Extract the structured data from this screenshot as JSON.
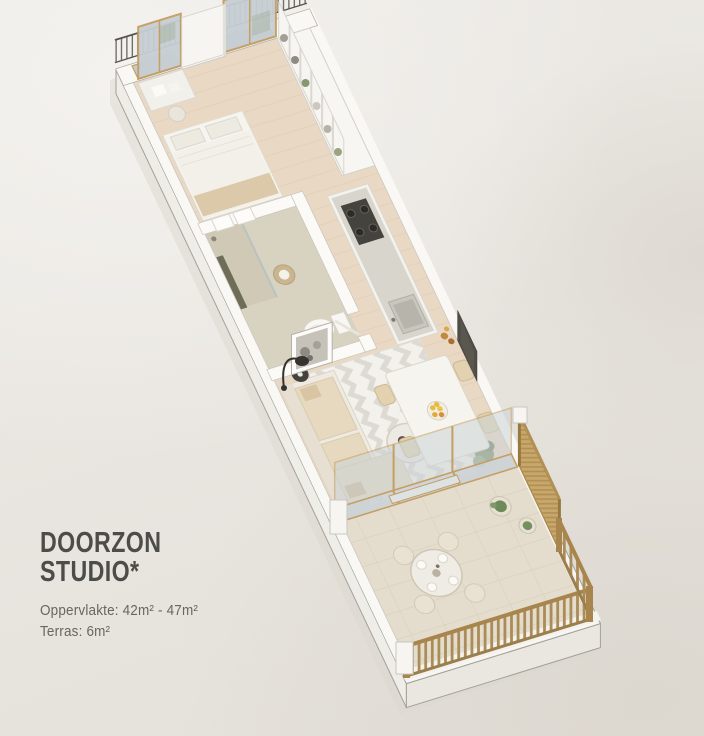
{
  "page": {
    "background": "#e8e5e0"
  },
  "title": {
    "line1": "DOORZON",
    "line2": "STUDIO*"
  },
  "details": {
    "area": "Oppervlakte: 42m² - 47m²",
    "terrace": "Terras: 6m²"
  },
  "floorplan": {
    "view": "axonometric 3D studio floor plan, long axis running top-left to bottom-right",
    "rooms": [
      "bedroom",
      "bathroom",
      "kitchen",
      "living-dining",
      "terrace"
    ],
    "features": [
      "french-balcony-railing",
      "floor-to-ceiling-windows",
      "bed",
      "desk",
      "shower",
      "toilet",
      "towel-rack",
      "built-in-shelving",
      "kitchen-counter-with-cooktop-and-sink",
      "sofa",
      "chevron-rug",
      "coffee-table",
      "arc-floor-lamp",
      "framed-artwork",
      "wall-tv",
      "dining-table-with-fruit-bowl",
      "four-chairs",
      "potted-plants",
      "sliding-glass-doors",
      "terrace-round-table",
      "wooden-slat-railing",
      "woven-privacy-screen"
    ],
    "colors": {
      "paper": "#e8e5e0",
      "slab": "#f7f6f2",
      "wood_floor": "#e9d8c4",
      "terrace_floor": "#e4ddcd",
      "glass": "#c7cfd4",
      "window_frame": "#c49e63",
      "metal_railing": "#57544d",
      "terrace_wood": "#ab8c58",
      "woven_screen": "#c8a76a",
      "plant": "#7d9167",
      "fruit": "#e8bb3c",
      "cooktop": "#44433e",
      "tv": "#504d46",
      "title_text": "#4c4c49",
      "detail_text": "#67665f"
    }
  }
}
